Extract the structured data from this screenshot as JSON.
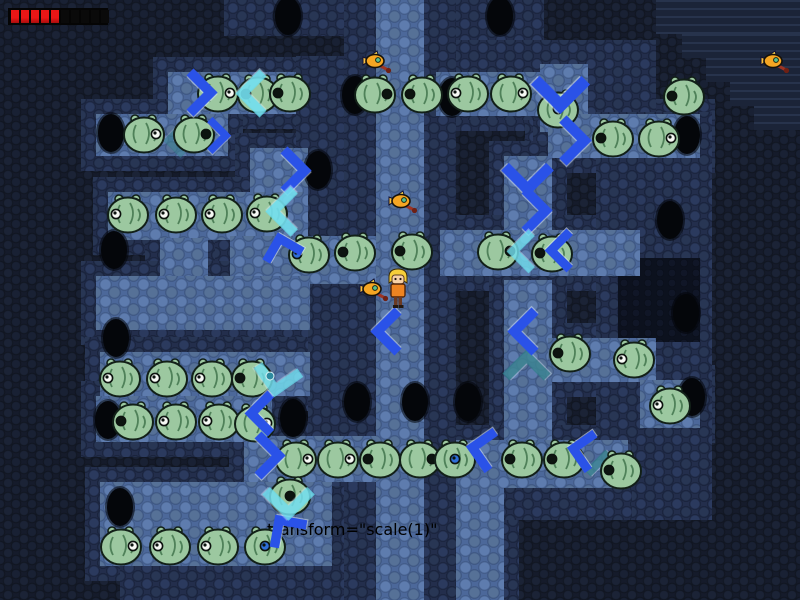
{
  "hud": {
    "health": {
      "segments_filled": 5,
      "segments_total": 10,
      "filled_color": "#ea1616",
      "filled_dark": "#a90d0d",
      "empty_color": "#0a0a0a",
      "bar_bg": "#050505"
    }
  },
  "palette": {
    "background_dark": "#151b2b",
    "wall_blue": "#232e4c",
    "floor_blue": "#4c689a",
    "pit_dark": "#0c111e",
    "hole_black": "#04060a",
    "chevron_blue": "#2a52e8",
    "chevron_cyan": "rgba(105,222,238,0.82)",
    "chevron_teal": "rgba(47,125,138,0.85)",
    "puffer_green": "#9cc8a0",
    "puffer_line": "#4f8159",
    "fish_orange": "#f5a623",
    "player_shirt": "#ee8422",
    "player_hair": "#f6cf3a"
  },
  "map": {
    "wall_pad": 15,
    "walls": [
      [
        344,
        0,
        112,
        600
      ],
      [
        224,
        0,
        120,
        36
      ],
      [
        456,
        0,
        88,
        72
      ],
      [
        456,
        40,
        200,
        80
      ],
      [
        596,
        112,
        116,
        408
      ],
      [
        456,
        440,
        176,
        80
      ],
      [
        308,
        236,
        68,
        250
      ],
      [
        296,
        56,
        48,
        190
      ],
      [
        120,
        560,
        224,
        40
      ]
    ],
    "floors": [
      [
        376,
        0,
        48,
        600
      ],
      [
        168,
        72,
        128,
        42
      ],
      [
        96,
        114,
        132,
        42
      ],
      [
        250,
        148,
        58,
        46
      ],
      [
        108,
        192,
        200,
        48
      ],
      [
        160,
        238,
        48,
        40
      ],
      [
        230,
        236,
        146,
        48
      ],
      [
        96,
        276,
        214,
        54
      ],
      [
        100,
        352,
        210,
        44
      ],
      [
        96,
        396,
        176,
        46
      ],
      [
        244,
        436,
        132,
        46
      ],
      [
        100,
        482,
        232,
        84
      ],
      [
        436,
        72,
        152,
        44
      ],
      [
        540,
        64,
        48,
        68
      ],
      [
        548,
        114,
        152,
        44
      ],
      [
        504,
        156,
        48,
        84
      ],
      [
        440,
        230,
        200,
        46
      ],
      [
        504,
        280,
        48,
        164
      ],
      [
        548,
        338,
        108,
        44
      ],
      [
        640,
        380,
        60,
        48
      ],
      [
        456,
        440,
        172,
        48
      ],
      [
        456,
        440,
        48,
        160
      ]
    ],
    "pits": [
      [
        618,
        258,
        82,
        84
      ]
    ],
    "stairs": [
      [
        656,
        0,
        144,
        34
      ],
      [
        682,
        34,
        118,
        24
      ],
      [
        706,
        58,
        94,
        24
      ],
      [
        730,
        82,
        70,
        24
      ],
      [
        754,
        106,
        46,
        24
      ]
    ]
  },
  "entities": {
    "holes": [
      [
        288,
        16
      ],
      [
        500,
        16
      ],
      [
        355,
        95
      ],
      [
        452,
        97
      ],
      [
        111,
        133
      ],
      [
        687,
        135
      ],
      [
        318,
        170
      ],
      [
        670,
        220
      ],
      [
        114,
        250
      ],
      [
        686,
        313
      ],
      [
        116,
        338
      ],
      [
        692,
        397
      ],
      [
        357,
        402
      ],
      [
        415,
        402
      ],
      [
        468,
        402
      ],
      [
        108,
        420
      ],
      [
        293,
        418
      ],
      [
        120,
        507
      ]
    ],
    "puffers": [
      [
        218,
        92,
        "R",
        "white"
      ],
      [
        258,
        93,
        "L",
        "dark"
      ],
      [
        290,
        92,
        "L",
        "dark"
      ],
      [
        375,
        93,
        "R",
        "dark"
      ],
      [
        422,
        93,
        "L",
        "dark"
      ],
      [
        468,
        92,
        "L",
        "white"
      ],
      [
        511,
        92,
        "R",
        "white"
      ],
      [
        558,
        108,
        "C",
        "blue"
      ],
      [
        613,
        137,
        "L",
        "dark"
      ],
      [
        659,
        137,
        "R",
        "white"
      ],
      [
        684,
        95,
        "L",
        "dark"
      ],
      [
        144,
        133,
        "R",
        "white"
      ],
      [
        194,
        133,
        "R",
        "dark"
      ],
      [
        128,
        213,
        "L",
        "white"
      ],
      [
        176,
        213,
        "L",
        "white"
      ],
      [
        222,
        213,
        "L",
        "white"
      ],
      [
        267,
        212,
        "L",
        "white"
      ],
      [
        309,
        253,
        "L",
        "blue"
      ],
      [
        355,
        251,
        "L",
        "dark"
      ],
      [
        412,
        250,
        "L",
        "dark"
      ],
      [
        498,
        250,
        "R",
        "dark"
      ],
      [
        552,
        252,
        "L",
        "dark"
      ],
      [
        570,
        352,
        "L",
        "dark"
      ],
      [
        634,
        358,
        "L",
        "white"
      ],
      [
        670,
        404,
        "L",
        "white"
      ],
      [
        120,
        377,
        "L",
        "white"
      ],
      [
        167,
        377,
        "L",
        "white"
      ],
      [
        212,
        377,
        "L",
        "white"
      ],
      [
        252,
        377,
        "L",
        "dark"
      ],
      [
        133,
        420,
        "L",
        "dark"
      ],
      [
        176,
        420,
        "L",
        "white"
      ],
      [
        219,
        420,
        "L",
        "white"
      ],
      [
        255,
        422,
        "R",
        "white"
      ],
      [
        296,
        458,
        "R",
        "white"
      ],
      [
        338,
        458,
        "R",
        "white"
      ],
      [
        380,
        458,
        "L",
        "dark"
      ],
      [
        420,
        458,
        "R",
        "dark"
      ],
      [
        455,
        458,
        "C",
        "blue"
      ],
      [
        522,
        458,
        "L",
        "dark"
      ],
      [
        564,
        458,
        "L",
        "dark"
      ],
      [
        621,
        469,
        "L",
        "dark"
      ],
      [
        290,
        495,
        "C",
        "dark"
      ],
      [
        121,
        545,
        "R",
        "white"
      ],
      [
        170,
        545,
        "L",
        "white"
      ],
      [
        218,
        545,
        "L",
        "white"
      ],
      [
        265,
        545,
        "C",
        "blue"
      ]
    ],
    "chevrons": [
      [
        193,
        92,
        "right",
        "blue",
        0,
        1.1,
        1
      ],
      [
        212,
        135,
        "right",
        "blue",
        0,
        0.85,
        1
      ],
      [
        287,
        170,
        "right",
        "blue",
        0,
        1.1,
        1
      ],
      [
        560,
        84,
        "down",
        "blue",
        0,
        1.35,
        1
      ],
      [
        566,
        140,
        "right",
        "blue",
        0,
        1.15,
        1
      ],
      [
        527,
        170,
        "down",
        "blue",
        0,
        1.2,
        1
      ],
      [
        528,
        210,
        "right",
        "blue",
        0,
        1.1,
        1
      ],
      [
        566,
        250,
        "left",
        "blue",
        0,
        1,
        1
      ],
      [
        283,
        253,
        "up",
        "blue",
        -15,
        1,
        1
      ],
      [
        394,
        331,
        "left",
        "blue",
        0,
        1.1,
        1
      ],
      [
        531,
        331,
        "left",
        "blue",
        0,
        1.1,
        1
      ],
      [
        267,
        413,
        "left",
        "blue",
        0,
        1.05,
        1
      ],
      [
        261,
        455,
        "right",
        "blue",
        0,
        1.1,
        1
      ],
      [
        488,
        450,
        "left",
        "blue",
        10,
        1.05,
        1
      ],
      [
        588,
        451,
        "left",
        "blue",
        10,
        1,
        1
      ],
      [
        288,
        533,
        "up",
        "blue",
        -35,
        1.05,
        1
      ],
      [
        259,
        93,
        "left",
        "cyan",
        0,
        1.1,
        1
      ],
      [
        290,
        211,
        "left",
        "cyan",
        0,
        1.15,
        1
      ],
      [
        528,
        251,
        "left",
        "cyan",
        0,
        1,
        0.9
      ],
      [
        278,
        372,
        "down",
        "cyan",
        10,
        1.15,
        0.9
      ],
      [
        288,
        494,
        "down",
        "cyan",
        0,
        1.2,
        0.95
      ],
      [
        526,
        373,
        "up",
        "teal",
        0,
        1.1,
        0.9
      ],
      [
        605,
        470,
        "up",
        "teal",
        0,
        0.95,
        0.85
      ],
      [
        180,
        140,
        "left",
        "teal",
        0,
        0.8,
        0.6
      ]
    ],
    "orbs": [
      [
        270,
        371
      ]
    ],
    "fish": [
      [
        377,
        62
      ],
      [
        403,
        202
      ],
      [
        374,
        290
      ],
      [
        775,
        62
      ]
    ],
    "player": {
      "x": 398,
      "y": 289
    }
  }
}
